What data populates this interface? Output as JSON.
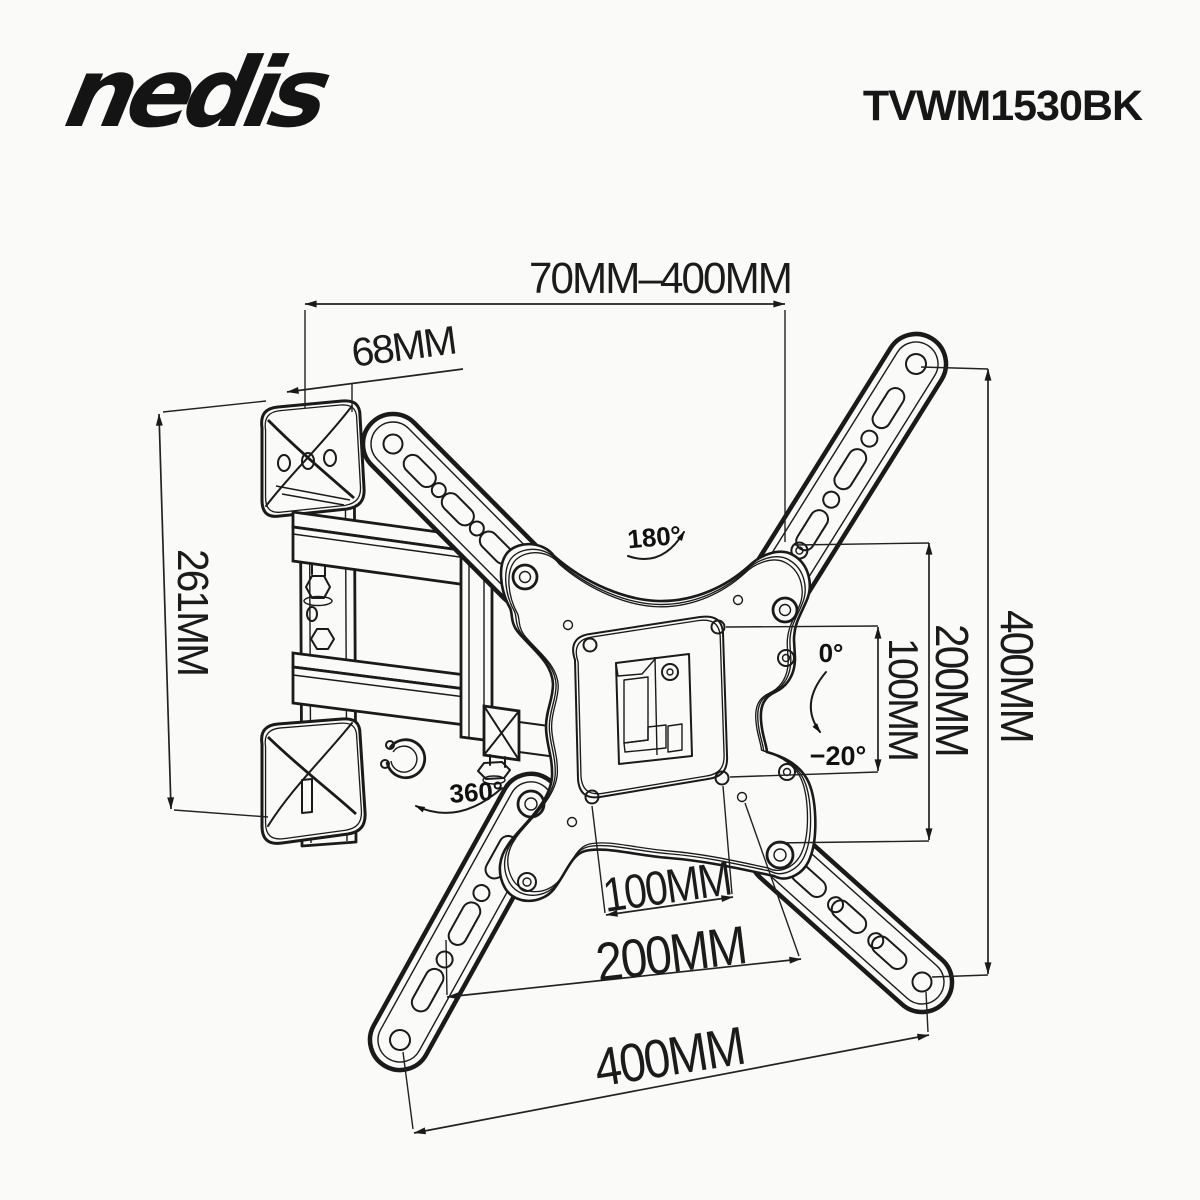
{
  "header": {
    "brand": "nedis",
    "model": "TVWM1530BK"
  },
  "dimensions": {
    "arm_extension_range": "70MM–400MM",
    "wall_bracket_width": "68MM",
    "wall_bracket_height": "261MM",
    "vesa_height_100": "100MM",
    "hole_height_200": "200MM",
    "hole_height_400": "400MM",
    "vesa_width_100": "100MM",
    "hole_width_200": "200MM",
    "hole_width_400": "400MM"
  },
  "angles": {
    "swivel": "180°",
    "tilt_up": "0°",
    "tilt_down": "−20°",
    "rotation": "360°"
  }
}
